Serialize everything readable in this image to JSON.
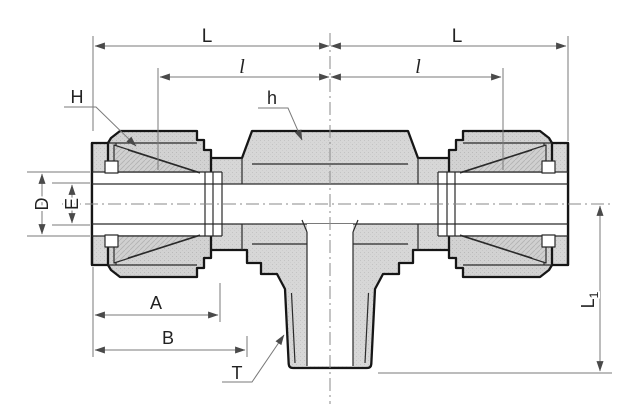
{
  "drawing": {
    "kind": "technical-drawing-compression-tube-fitting-branch-tee-section-view",
    "labels": {
      "L_left": "L",
      "L_right": "L",
      "l_left": "l",
      "l_right": "l",
      "H": "H",
      "h": "h",
      "D": "D",
      "E": "E",
      "A": "A",
      "B": "B",
      "T": "T",
      "L1_main": "L",
      "L1_sub": "1"
    },
    "colors": {
      "background": "#ffffff",
      "body_fill": "#d7d7d7",
      "nut_fill": "#d2d2d2",
      "bore_fill": "#ffffff",
      "outline": "#161616",
      "dim_line": "#7a7a7a",
      "label": "#222222"
    }
  }
}
